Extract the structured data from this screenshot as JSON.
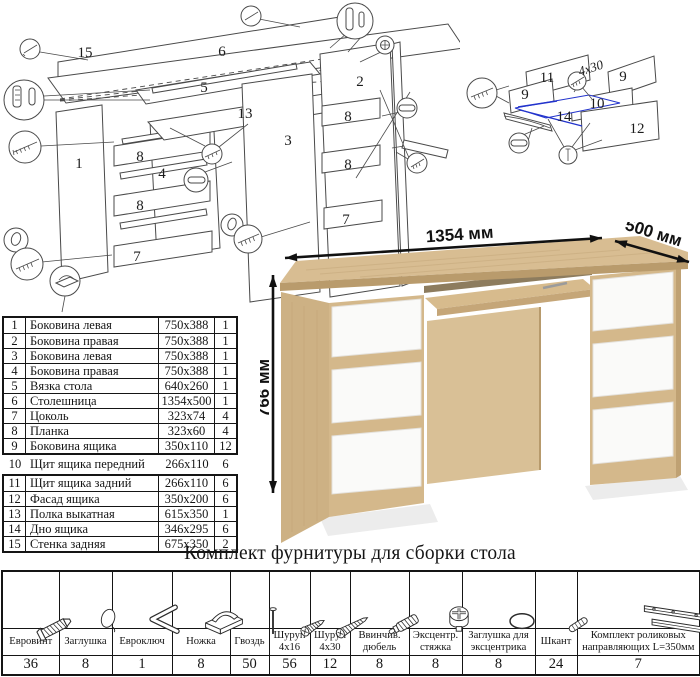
{
  "exploded_desk": {
    "labels": {
      "p15": "15",
      "p6": "6",
      "p5": "5",
      "p13": "13",
      "p1": "1",
      "p3": "3",
      "p2": "2",
      "p4": "4",
      "p8a": "8",
      "p8b": "8",
      "p8c": "8",
      "p8d": "8",
      "p7a": "7",
      "p7b": "7"
    }
  },
  "exploded_drawer": {
    "labels": {
      "p11": "11",
      "p9a": "9",
      "p9b": "9",
      "p10": "10",
      "p14": "14",
      "p12": "12"
    },
    "screw_note": "4x30",
    "highlight_color": "#2233cc"
  },
  "desk_render": {
    "dim_width": "1354 мм",
    "dim_depth": "500 мм",
    "dim_height": "766 мм",
    "colors": {
      "oak": "#d5b98c",
      "oak_edge": "#b99b6c",
      "drawer_white": "#fafaf9"
    }
  },
  "parts_table": {
    "rows": [
      {
        "num": "1",
        "name": "Боковина левая",
        "size": "750x388",
        "qty": "1"
      },
      {
        "num": "2",
        "name": "Боковина правая",
        "size": "750x388",
        "qty": "1"
      },
      {
        "num": "3",
        "name": "Боковина левая",
        "size": "750x388",
        "qty": "1"
      },
      {
        "num": "4",
        "name": "Боковина правая",
        "size": "750x388",
        "qty": "1"
      },
      {
        "num": "5",
        "name": "Вязка стола",
        "size": "640x260",
        "qty": "1"
      },
      {
        "num": "6",
        "name": "Столешница",
        "size": "1354x500",
        "qty": "1"
      },
      {
        "num": "7",
        "name": "Цоколь",
        "size": "323x74",
        "qty": "4"
      },
      {
        "num": "8",
        "name": "Планка",
        "size": "323x60",
        "qty": "4"
      },
      {
        "num": "9",
        "name": "Боковина ящика",
        "size": "350x110",
        "qty": "12"
      },
      {
        "num": "10",
        "name": "Щит ящика передний",
        "size": "266x110",
        "qty": "6"
      },
      {
        "num": "11",
        "name": "Щит ящика задний",
        "size": "266x110",
        "qty": "6"
      },
      {
        "num": "12",
        "name": "Фасад ящика",
        "size": "350x200",
        "qty": "6"
      },
      {
        "num": "13",
        "name": "Полка выкатная",
        "size": "615x350",
        "qty": "1"
      },
      {
        "num": "14",
        "name": "Дно ящика",
        "size": "346x295",
        "qty": "6"
      },
      {
        "num": "15",
        "name": "Стенка задняя",
        "size": "675x350",
        "qty": "2"
      }
    ]
  },
  "hardware": {
    "title": "Комплект фурнитуры для сборки стола",
    "items": [
      {
        "name": "Евровинт",
        "qty": "36",
        "icon": "euro-screw-icon"
      },
      {
        "name": "Заглушка",
        "qty": "8",
        "icon": "cap-icon"
      },
      {
        "name": "Евроключ",
        "qty": "1",
        "icon": "hex-key-icon"
      },
      {
        "name": "Ножка",
        "qty": "8",
        "icon": "foot-icon"
      },
      {
        "name": "Гвоздь",
        "qty": "50",
        "icon": "nail-icon"
      },
      {
        "name": "Шуруп 4x16",
        "qty": "56",
        "icon": "screw-short-icon"
      },
      {
        "name": "Шуруп 4x30",
        "qty": "12",
        "icon": "screw-long-icon"
      },
      {
        "name": "Ввинчив. дюбель",
        "qty": "8",
        "icon": "screw-dowel-icon"
      },
      {
        "name": "Эксцентр. стяжка",
        "qty": "8",
        "icon": "cam-lock-icon"
      },
      {
        "name": "Заглушка для эксцентрика",
        "qty": "8",
        "icon": "cam-cap-icon"
      },
      {
        "name": "Шкант",
        "qty": "24",
        "icon": "dowel-icon"
      },
      {
        "name": "Комплект роликовых направляющих L=350мм",
        "qty": "7",
        "icon": "drawer-slide-icon"
      }
    ]
  }
}
